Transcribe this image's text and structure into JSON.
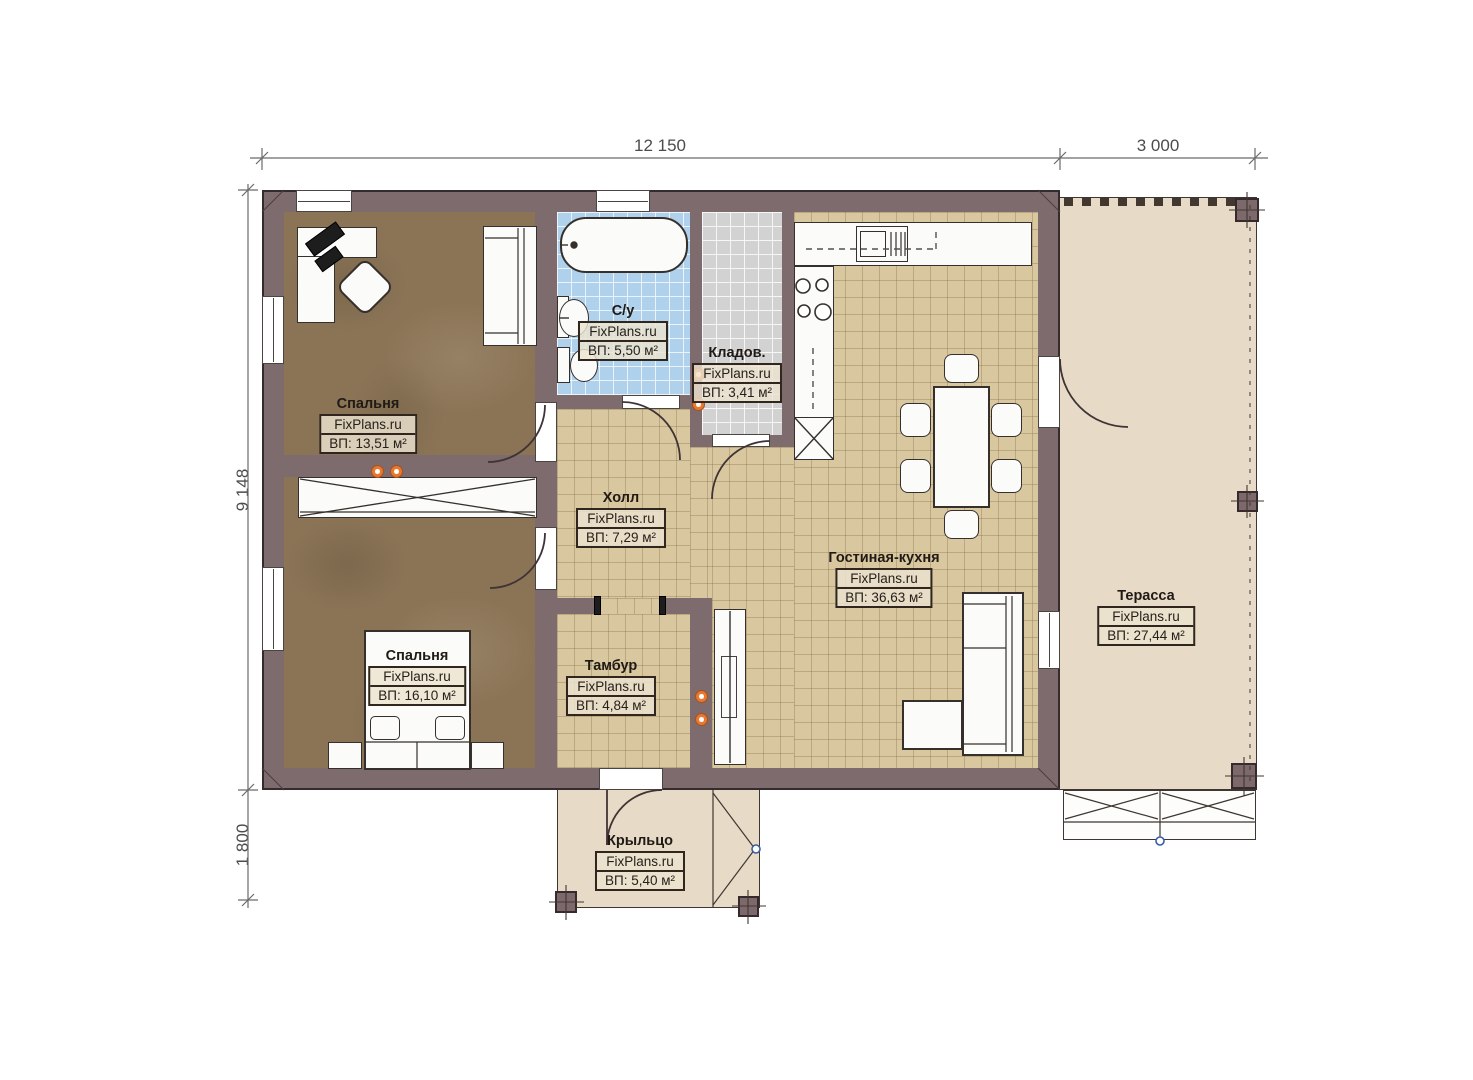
{
  "title": "План дома FixPlans.ru",
  "dimensions": {
    "top": [
      {
        "label": "12 150"
      },
      {
        "label": "3 000"
      }
    ],
    "left": [
      {
        "label": "9 148"
      },
      {
        "label": "1 800"
      }
    ]
  },
  "rooms": [
    {
      "id": "bedroom-1",
      "name": "Спальня",
      "brand": "FixPlans.ru",
      "area": "ВП: 13,51 м²"
    },
    {
      "id": "bathroom",
      "name": "С/у",
      "brand": "FixPlans.ru",
      "area": "ВП: 5,50 м²"
    },
    {
      "id": "storage",
      "name": "Кладов.",
      "brand": "FixPlans.ru",
      "area": "ВП: 3,41 м²"
    },
    {
      "id": "hall",
      "name": "Холл",
      "brand": "FixPlans.ru",
      "area": "ВП: 7,29 м²"
    },
    {
      "id": "living-kitchen",
      "name": "Гостиная-кухня",
      "brand": "FixPlans.ru",
      "area": "ВП: 36,63 м²"
    },
    {
      "id": "bedroom-2",
      "name": "Спальня",
      "brand": "FixPlans.ru",
      "area": "ВП: 16,10 м²"
    },
    {
      "id": "vestibule",
      "name": "Тамбур",
      "brand": "FixPlans.ru",
      "area": "ВП: 4,84 м²"
    },
    {
      "id": "terrace",
      "name": "Терасса",
      "brand": "FixPlans.ru",
      "area": "ВП: 27,44 м²"
    },
    {
      "id": "porch",
      "name": "Крыльцо",
      "brand": "FixPlans.ru",
      "area": "ВП: 5,40 м²"
    }
  ],
  "colors": {
    "wall": "#7e6b6e",
    "floor_wood": "#8b7456",
    "floor_tile_tan": "#d8c79f",
    "floor_tile_blue": "#b0d1ec",
    "floor_tile_gray": "#d2d2d2",
    "terrace": "#e7dbc7",
    "outlet_accent": "#e8772f"
  }
}
